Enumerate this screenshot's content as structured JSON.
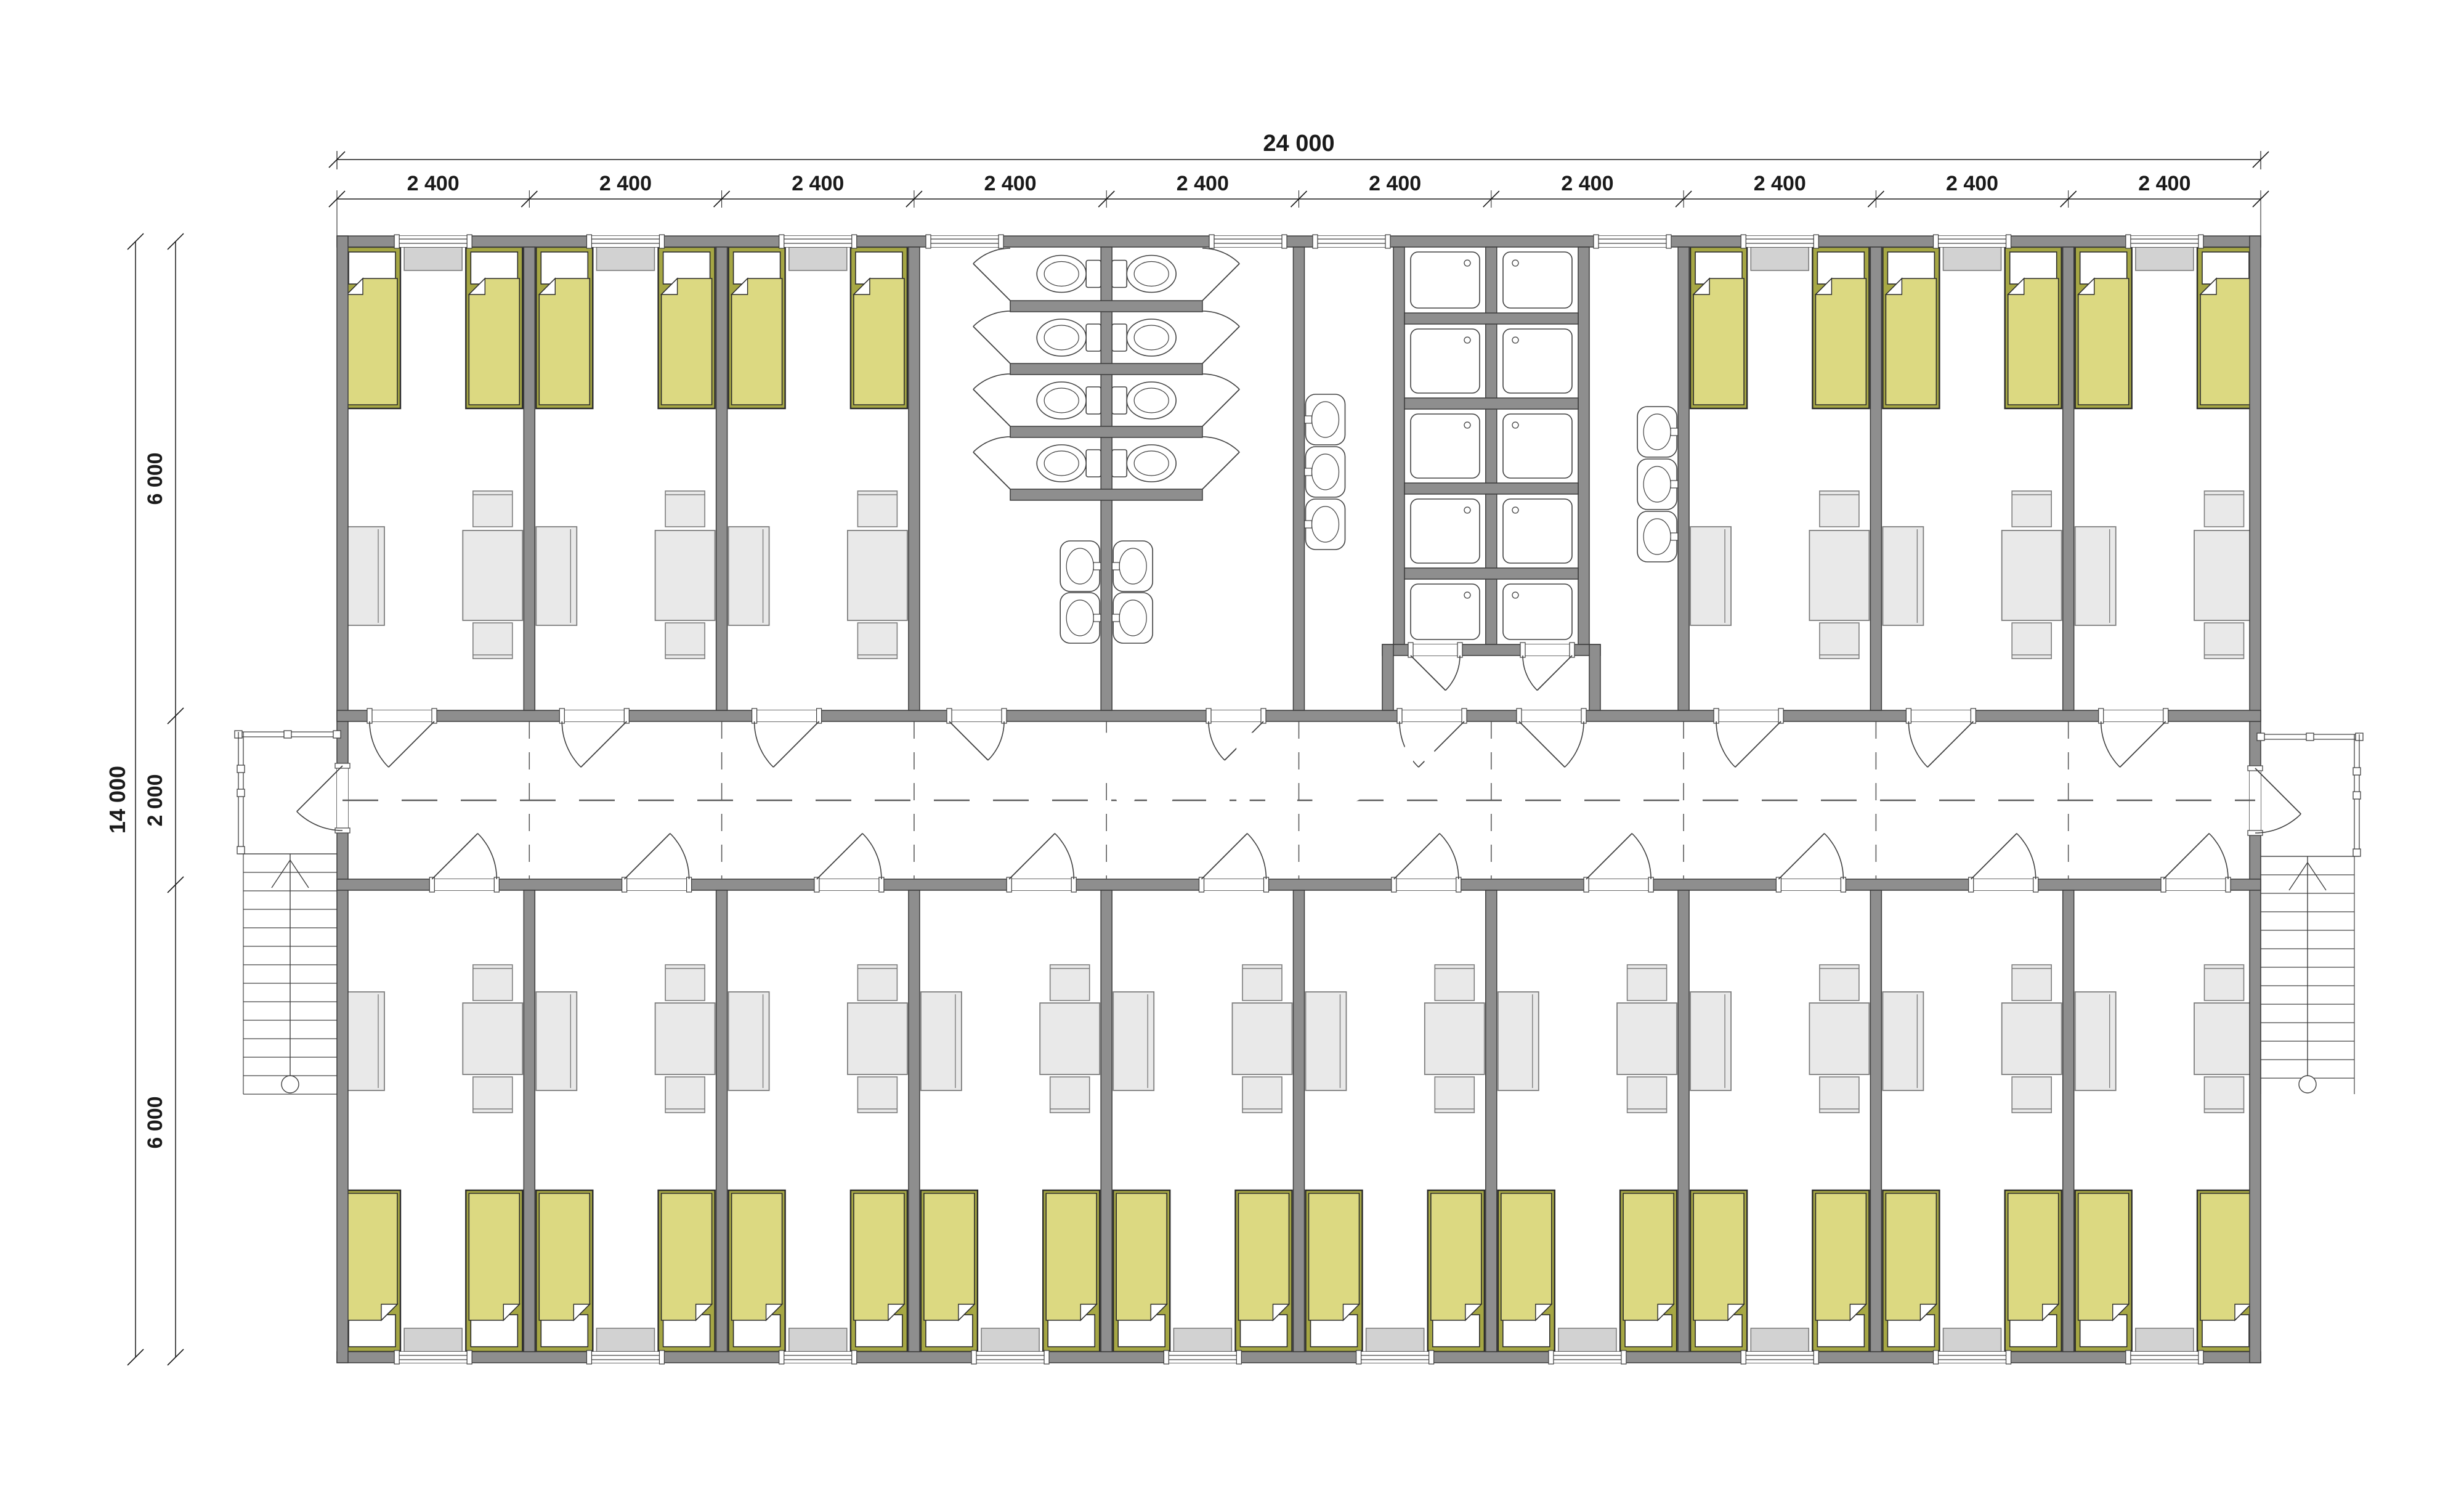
{
  "document": {
    "type": "architectural-floor-plan",
    "description": "Modular dormitory building floor plan, 10 modules of 2400 mm, central corridor, bedrooms with beds, WC block and shower block, external staircases on both ends"
  },
  "watermark": {
    "left_text": "VAN",
    "right_text": "DA",
    "pink": "#f6c9d1",
    "pink_facet": "#ec96a3",
    "blue": "#cfe3f4",
    "blue_facet": "#b5d2ec",
    "text_color": "#ffffff"
  },
  "dimensions": {
    "top_total": "24 000",
    "top_modules": [
      "2 400",
      "2 400",
      "2 400",
      "2 400",
      "2 400",
      "2 400",
      "2 400",
      "2 400",
      "2 400",
      "2 400"
    ],
    "left_total": "14 000",
    "left_segments": [
      "6 000",
      "2 000",
      "6 000"
    ]
  },
  "colors": {
    "background": "#ffffff",
    "wall_fill": "#8e8e8e",
    "wall_stroke": "#3c3c3c",
    "bed_frame": "#a6a744",
    "bed_blanket": "#dcd981",
    "outline": "#2b2b2b",
    "furniture_fill": "#e9e9e9",
    "furniture_stroke": "#7d7d7d",
    "cabinet_fill": "#d2d2d2",
    "fixture_stroke": "#404040",
    "dashed_line": "#5a5a5a",
    "dimension": "#1a1a1a"
  },
  "inventory": {
    "bedrooms": 16,
    "beds": 32,
    "toilet_stalls": 8,
    "shower_trays": 10,
    "washbasins": 10,
    "tables": 16,
    "chairs": 32,
    "wardrobes": 16,
    "window_cabinets": 16,
    "staircases": 2,
    "corridors": 1
  }
}
